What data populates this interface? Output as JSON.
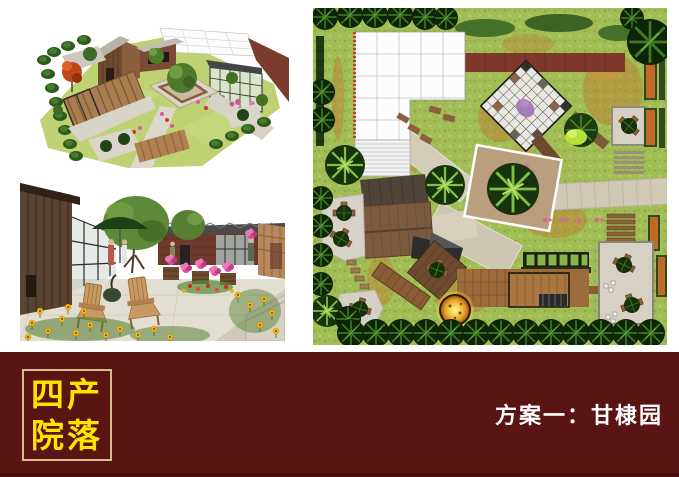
{
  "banner": {
    "title_line1": "四产",
    "title_line2": "院落",
    "scheme_label": "方案一：甘棣园"
  },
  "colors": {
    "banner_bg": "#5a1412",
    "banner_bottom_line": "#470d0d",
    "title_text": "#ffe400",
    "title_box_border": "#d5bf8d",
    "scheme_text": "#ffffff",
    "plan_grass": "#a2bd55",
    "plan_canopy_white": "#fcfcfc",
    "plan_red_bar": "#7d372b",
    "plan_wood_deck": "#9c6b3a",
    "plan_paving": "#d6d1c4",
    "autumn_groundcover": "#c1742c"
  },
  "panels": {
    "aerial_render_alt": "3D aerial rendering of courtyard garden with barn, greenhouse, canopy and planting beds",
    "perspective_render_alt": "Eye-level rendering with wooden chairs, green umbrella, flower barrels and yellow poppies",
    "site_plan_alt": "Top-down landscape site plan with white canopy grid, checkered plaza, buildings, decks and tree borders"
  }
}
